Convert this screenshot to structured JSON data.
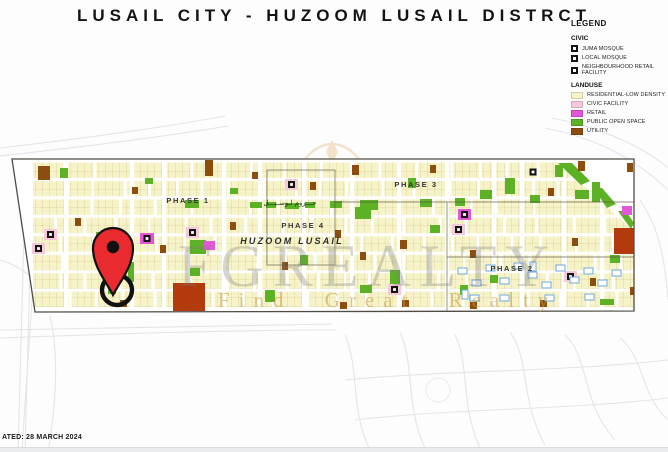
{
  "title": "LUSAIL CITY - HUZOOM LUSAIL DISTRCT",
  "legend": {
    "heading": "LEGEND",
    "civic": {
      "heading": "CIVIC",
      "items": [
        {
          "icon": "juma-mosque-icon",
          "label": "JUMA MOSQUE"
        },
        {
          "icon": "local-mosque-icon",
          "label": "LOCAL MOSQUE"
        },
        {
          "icon": "neighbourhood-retail-facility-icon",
          "label": "NEIGHBOURHOOD RETAIL FACILITY"
        }
      ]
    },
    "landuse": {
      "heading": "LANDUSE",
      "items": [
        {
          "label": "RESIDENTIAL-LOW DENSITY",
          "color": "#F7F3C8"
        },
        {
          "label": "CIVIC FACILITY",
          "color": "#F4C9DA"
        },
        {
          "label": "RETAIL",
          "color": "#E356D8"
        },
        {
          "label": "PUBLIC OPEN SPACE",
          "color": "#5DB125"
        },
        {
          "label": "UTILITY",
          "color": "#8C4D0F"
        }
      ]
    }
  },
  "map": {
    "phase_labels": [
      {
        "label": "PHASE 1",
        "x": 188,
        "y": 203
      },
      {
        "label": "PHASE 3",
        "x": 416,
        "y": 187
      },
      {
        "label": "PHASE 4",
        "x": 303,
        "y": 228
      },
      {
        "label": "PHASE 2",
        "x": 512,
        "y": 271
      }
    ],
    "district_label": "HUZOOM LUSAIL",
    "arabic_label": "حـــزوم لـوسـيـــل",
    "colors": {
      "residential": "#F7F3C8",
      "residential_grid": "#CFC083",
      "civic": "#F4C9DA",
      "retail": "#E356D8",
      "open_space": "#5DB125",
      "utility": "#8C4D0F",
      "brick": "#B23A0D",
      "blue_outline": "#6FA8DC",
      "boundary": "#4F4D45",
      "pin": "#E92A2E"
    }
  },
  "watermark": {
    "brand": "FGREALTY",
    "tagline": "Find Great Realty"
  },
  "footer": {
    "updated": "ATED: 28 MARCH 2024"
  }
}
